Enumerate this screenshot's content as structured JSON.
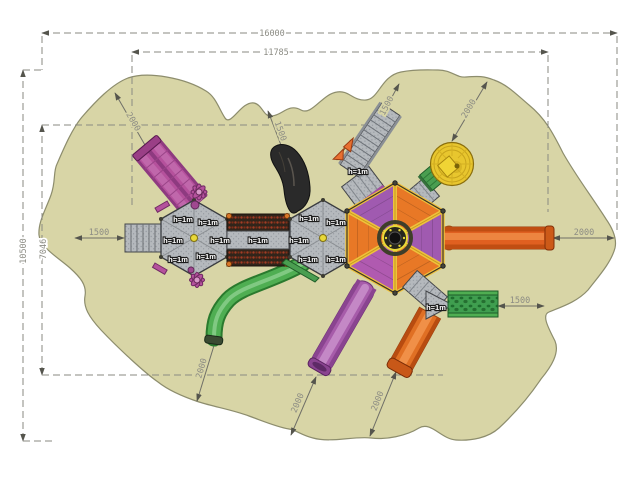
{
  "drawing": {
    "type": "playground-top-view-plan",
    "dimensions": {
      "overall_width": "16000",
      "inner_width": "11785",
      "overall_height": "10500",
      "inner_height": "7046",
      "left_clearance": "1500",
      "right_clearance": "2000",
      "right_lower_clearance": "1500",
      "top_clearance_1": "2000",
      "top_clearance_2": "1500",
      "top_clearance_3": "1500",
      "top_clearance_4": "2000",
      "bottom_clearance_1": "2000",
      "bottom_clearance_2": "2000",
      "bottom_clearance_3": "2000"
    },
    "labels": {
      "platform_height": "h=1m"
    },
    "colors": {
      "safety_surface": "#d8d5a6",
      "platform_gray": "#b5b9bd",
      "roof_orange": "#e87826",
      "roof_purple": "#a05ab0",
      "ridge_yellow": "#eec23c",
      "slide_green": "#4fae52",
      "slide_purple": "#a75caa",
      "slide_orange": "#e06020",
      "equipment_magenta": "#b5519c",
      "dome_yellow": "#e8c62e",
      "climb_wall_green": "#3f9e4f",
      "dimension_gray": "#8c8c84"
    }
  }
}
